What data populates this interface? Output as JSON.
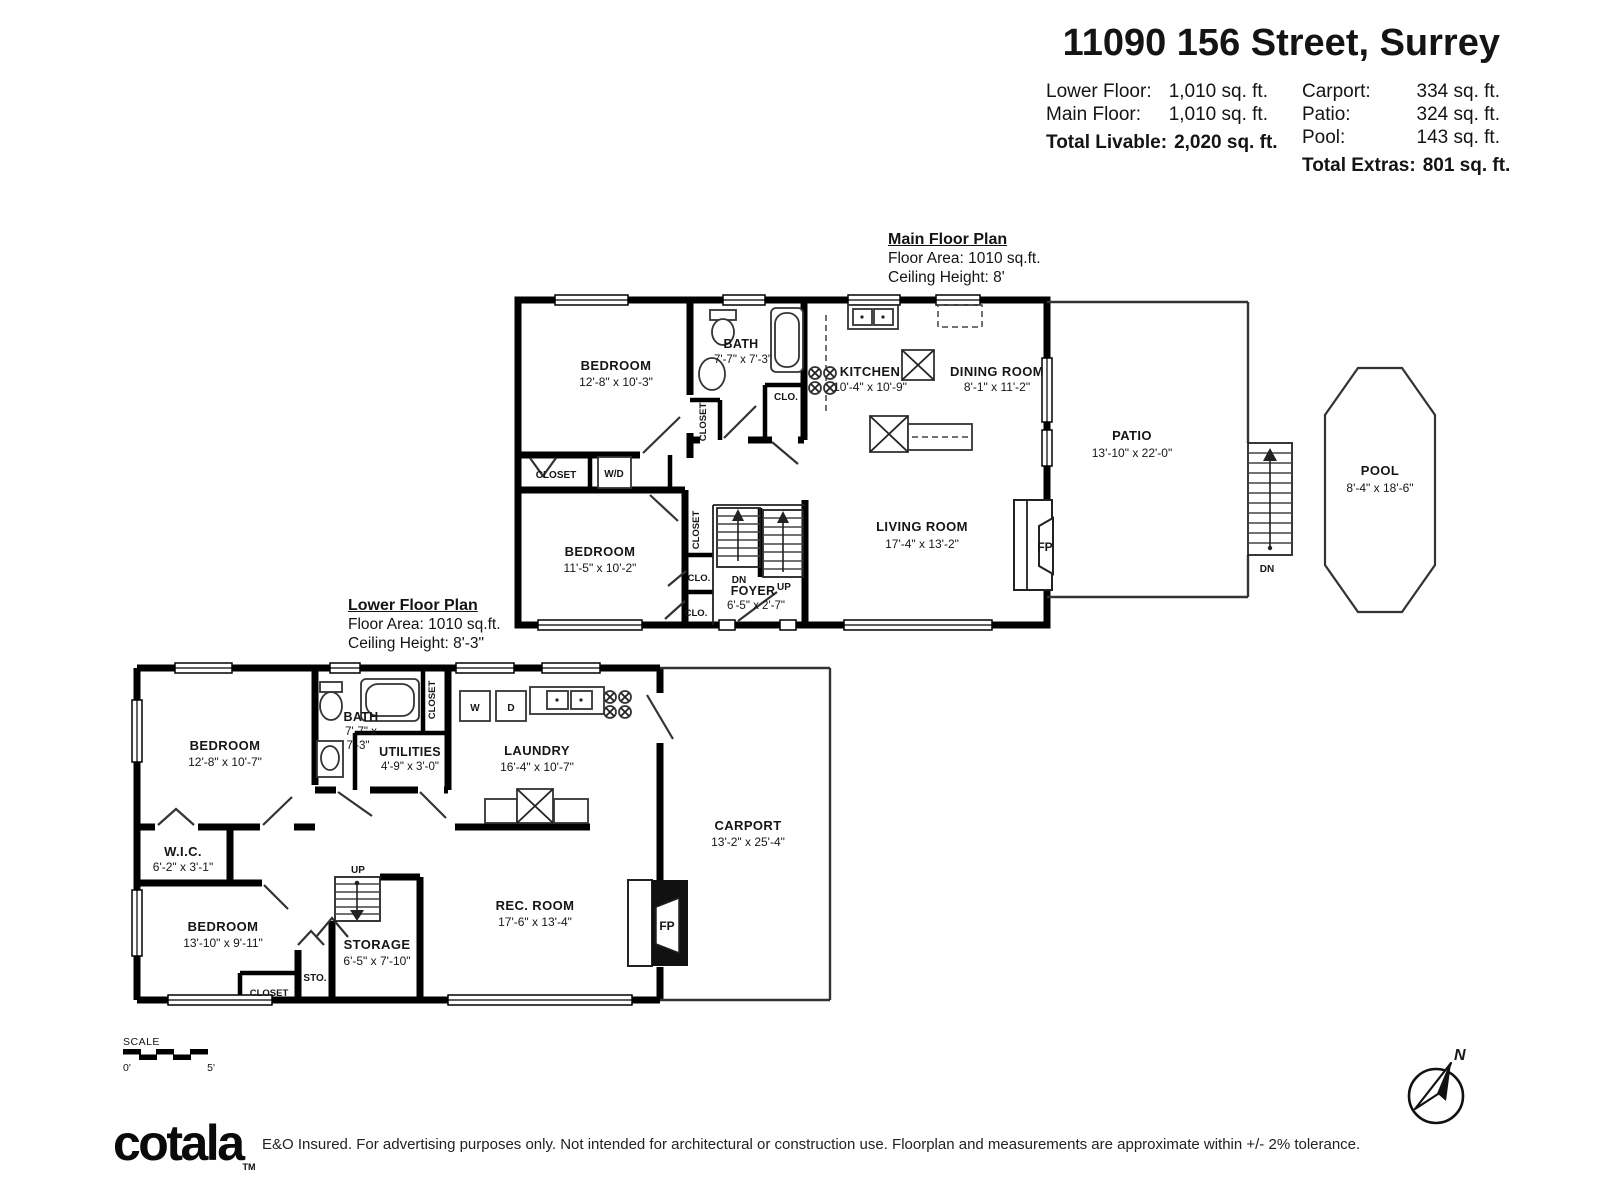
{
  "header": {
    "title": "11090 156 Street, Surrey",
    "rows_left": [
      {
        "label": "Lower Floor:",
        "value": "1,010 sq. ft."
      },
      {
        "label": "Main Floor:",
        "value": "1,010 sq. ft."
      }
    ],
    "total_left_label": "Total Livable:",
    "total_left_value": "2,020 sq. ft.",
    "rows_right": [
      {
        "label": "Carport:",
        "value": "334 sq. ft."
      },
      {
        "label": "Patio:",
        "value": "324 sq. ft."
      },
      {
        "label": "Pool:",
        "value": "143 sq. ft."
      }
    ],
    "total_right_label": "Total Extras:",
    "total_right_value": "801 sq. ft."
  },
  "main_floor": {
    "title": "Main Floor Plan",
    "area": "Floor Area: 1010 sq.ft.",
    "ceiling": "Ceiling Height: 8'",
    "bedroom1": {
      "name": "BEDROOM",
      "dims": "12'-8\" x 10'-3\""
    },
    "bath": {
      "name": "BATH",
      "dims": "7'-7\" x 7'-3\""
    },
    "bedroom2": {
      "name": "BEDROOM",
      "dims": "11'-5\" x 10'-2\""
    },
    "foyer": {
      "name": "FOYER",
      "dims": "6'-5\" x 2'-7\""
    },
    "kitchen": {
      "name": "KITCHEN",
      "dims": "10'-4\" x 10'-9\""
    },
    "dining": {
      "name": "DINING ROOM",
      "dims": "8'-1\" x 11'-2\""
    },
    "living": {
      "name": "LIVING ROOM",
      "dims": "17'-4\" x 13'-2\""
    },
    "patio": {
      "name": "PATIO",
      "dims": "13'-10\" x 22'-0\""
    },
    "pool": {
      "name": "POOL",
      "dims": "8'-4\" x 18'-6\""
    }
  },
  "lower_floor": {
    "title": "Lower Floor Plan",
    "area": "Floor Area: 1010 sq.ft.",
    "ceiling": "Ceiling Height: 8'-3\"",
    "bedroom1": {
      "name": "BEDROOM",
      "dims": "12'-8\" x 10'-7\""
    },
    "bath": {
      "name": "BATH",
      "dims1": "7'-7\" x",
      "dims2": "7'-3\""
    },
    "utilities": {
      "name": "UTILITIES",
      "dims": "4'-9\" x 3'-0\""
    },
    "laundry": {
      "name": "LAUNDRY",
      "dims": "16'-4\" x 10'-7\""
    },
    "wic": {
      "name": "W.I.C.",
      "dims": "6'-2\" x 3'-1\""
    },
    "bedroom2": {
      "name": "BEDROOM",
      "dims": "13'-10\" x 9'-11\""
    },
    "storage": {
      "name": "STORAGE",
      "dims": "6'-5\" x 7'-10\""
    },
    "recroom": {
      "name": "REC. ROOM",
      "dims": "17'-6\" x 13'-4\""
    },
    "carport": {
      "name": "CARPORT",
      "dims": "13'-2\" x 25'-4\""
    }
  },
  "labels": {
    "closet": "CLOSET",
    "clo": "CLO.",
    "wd": "W/D",
    "w": "W",
    "d": "D",
    "fp": "FP",
    "up": "UP",
    "dn": "DN",
    "sto": "STO.",
    "n": "N"
  },
  "scale": {
    "label": "SCALE",
    "start": "0'",
    "end": "5'"
  },
  "footer": {
    "logo": "cotala",
    "tm": "TM",
    "disclaimer": "E&O Insured. For advertising purposes only. Not intended for architectural or construction use. Floorplan and measurements are approximate within +/- 2% tolerance."
  }
}
